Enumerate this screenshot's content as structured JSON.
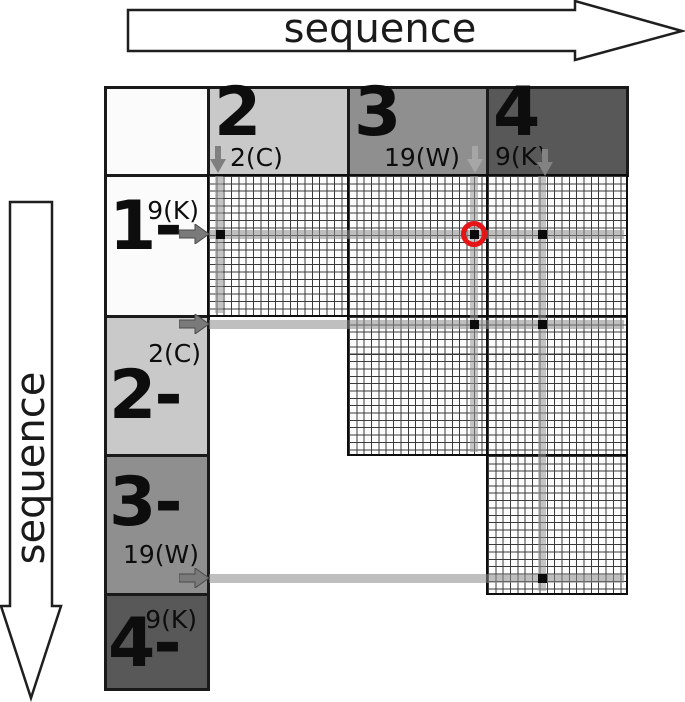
{
  "axis": {
    "horizontal_label": "sequence",
    "vertical_label": "sequence"
  },
  "matrix": {
    "column_headers": [
      {
        "number": "2",
        "annotation": "2(C)"
      },
      {
        "number": "3",
        "annotation": "19(W)"
      },
      {
        "number": "4",
        "annotation": "9(K)"
      }
    ],
    "row_headers": [
      {
        "number": "1-",
        "annotation": "9(K)"
      },
      {
        "number": "2-",
        "annotation": "2(C)"
      },
      {
        "number": "3-",
        "annotation": "19(W)"
      },
      {
        "number": "4-",
        "annotation": "9(K)"
      }
    ]
  },
  "diagram": {
    "column_highlights": [
      {
        "x": 219,
        "top": 176,
        "bottom": 313,
        "label": "2(C)"
      },
      {
        "x": 474,
        "top": 176,
        "bottom": 452,
        "label": "19(W)"
      },
      {
        "x": 542,
        "top": 176,
        "bottom": 591,
        "label": "9(K)"
      }
    ],
    "row_highlights": [
      {
        "y": 234,
        "left": 209,
        "right": 624,
        "label": "9(K)"
      },
      {
        "y": 324,
        "left": 209,
        "right": 624,
        "label": "2(C)"
      },
      {
        "y": 578,
        "left": 209,
        "right": 624,
        "label": "19(W)"
      }
    ],
    "match_points": [
      {
        "x": 220,
        "y": 234,
        "circled": false
      },
      {
        "x": 474,
        "y": 234,
        "circled": true
      },
      {
        "x": 542,
        "y": 234,
        "circled": false
      },
      {
        "x": 474,
        "y": 324,
        "circled": false
      },
      {
        "x": 542,
        "y": 324,
        "circled": false
      },
      {
        "x": 542,
        "y": 578,
        "circled": false
      }
    ]
  },
  "colors": {
    "segment_white": "#fbfbfb",
    "segment_light": "#c9c9c9",
    "segment_medium": "#8f8f8f",
    "segment_dark": "#585858",
    "highlight_red": "#e41417",
    "arrow_gray": "#7a7a7a"
  }
}
